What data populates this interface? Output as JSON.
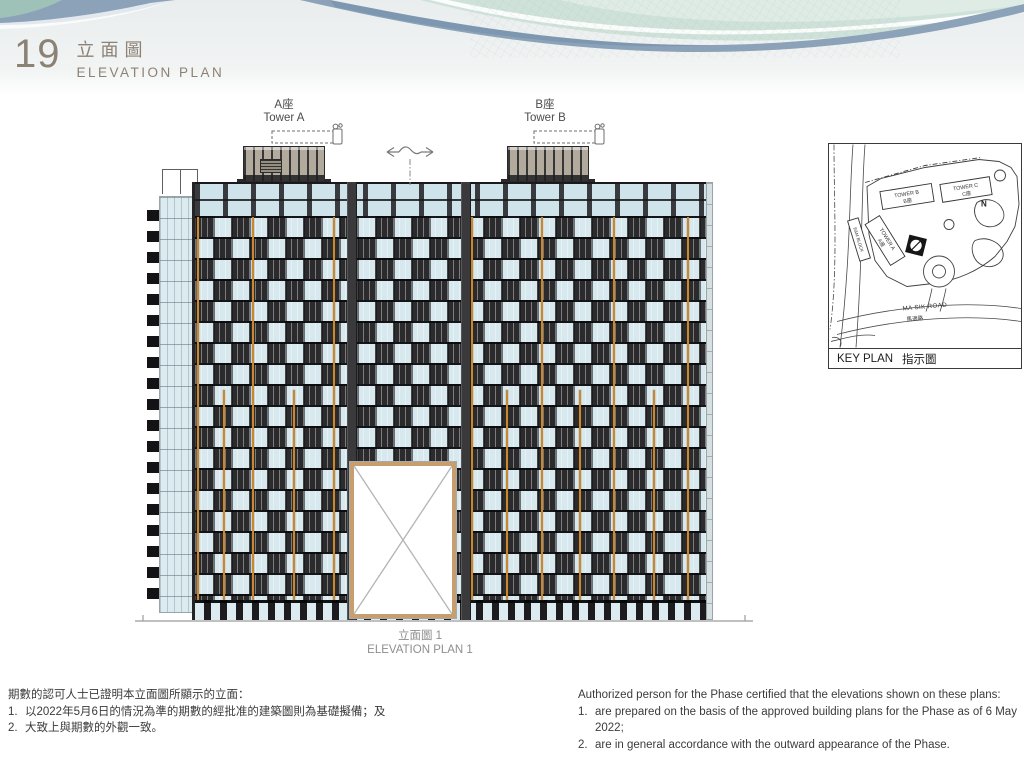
{
  "page": {
    "number": "19",
    "title_zh": "立面圖",
    "title_en": "ELEVATION PLAN"
  },
  "drawing": {
    "tower_a": {
      "zh": "A座",
      "en": "Tower A"
    },
    "tower_b": {
      "zh": "B座",
      "en": "Tower B"
    },
    "caption_zh": "立面圖 1",
    "caption_en": "ELEVATION PLAN 1"
  },
  "key_plan": {
    "title_en": "KEY PLAN",
    "title_zh": "指示圖",
    "tower_a_en": "TOWER A",
    "tower_a_zh": "A座",
    "tower_b_en": "TOWER B",
    "tower_b_zh": "B座",
    "tower_c_en": "TOWER C",
    "tower_c_zh": "C座",
    "em_block": "E&M BLOCK",
    "north_label": "N",
    "road_en": "MA SIK ROAD",
    "road_zh": "馬適路"
  },
  "notes_zh": {
    "intro": "期數的認可人士已證明本立面圖所顯示的立面：",
    "item1_num": "1.",
    "item1": "以2022年5月6日的情況為準的期數的經批准的建築圖則為基礎擬備；及",
    "item2_num": "2.",
    "item2": "大致上與期數的外觀一致。"
  },
  "notes_en": {
    "intro": "Authorized person for the Phase certified that the elevations shown on these plans:",
    "item1_num": "1.",
    "item1": "are prepared on the basis of the approved building plans for the Phase as of 6 May 2022;",
    "item2_num": "2.",
    "item2": "are in general accordance with the outward appearance of the Phase."
  },
  "colors": {
    "accent_orange": "#c9882f",
    "facade_dark": "#2b2b2d",
    "window_blue": "#d7e8ee",
    "penthouse_beige": "#b2aa9c",
    "opening_frame_tan": "#c79e6f",
    "wave_teal": "#cfe2da",
    "wave_blue": "#8ba2b9",
    "heading_gray": "#8c8175"
  }
}
